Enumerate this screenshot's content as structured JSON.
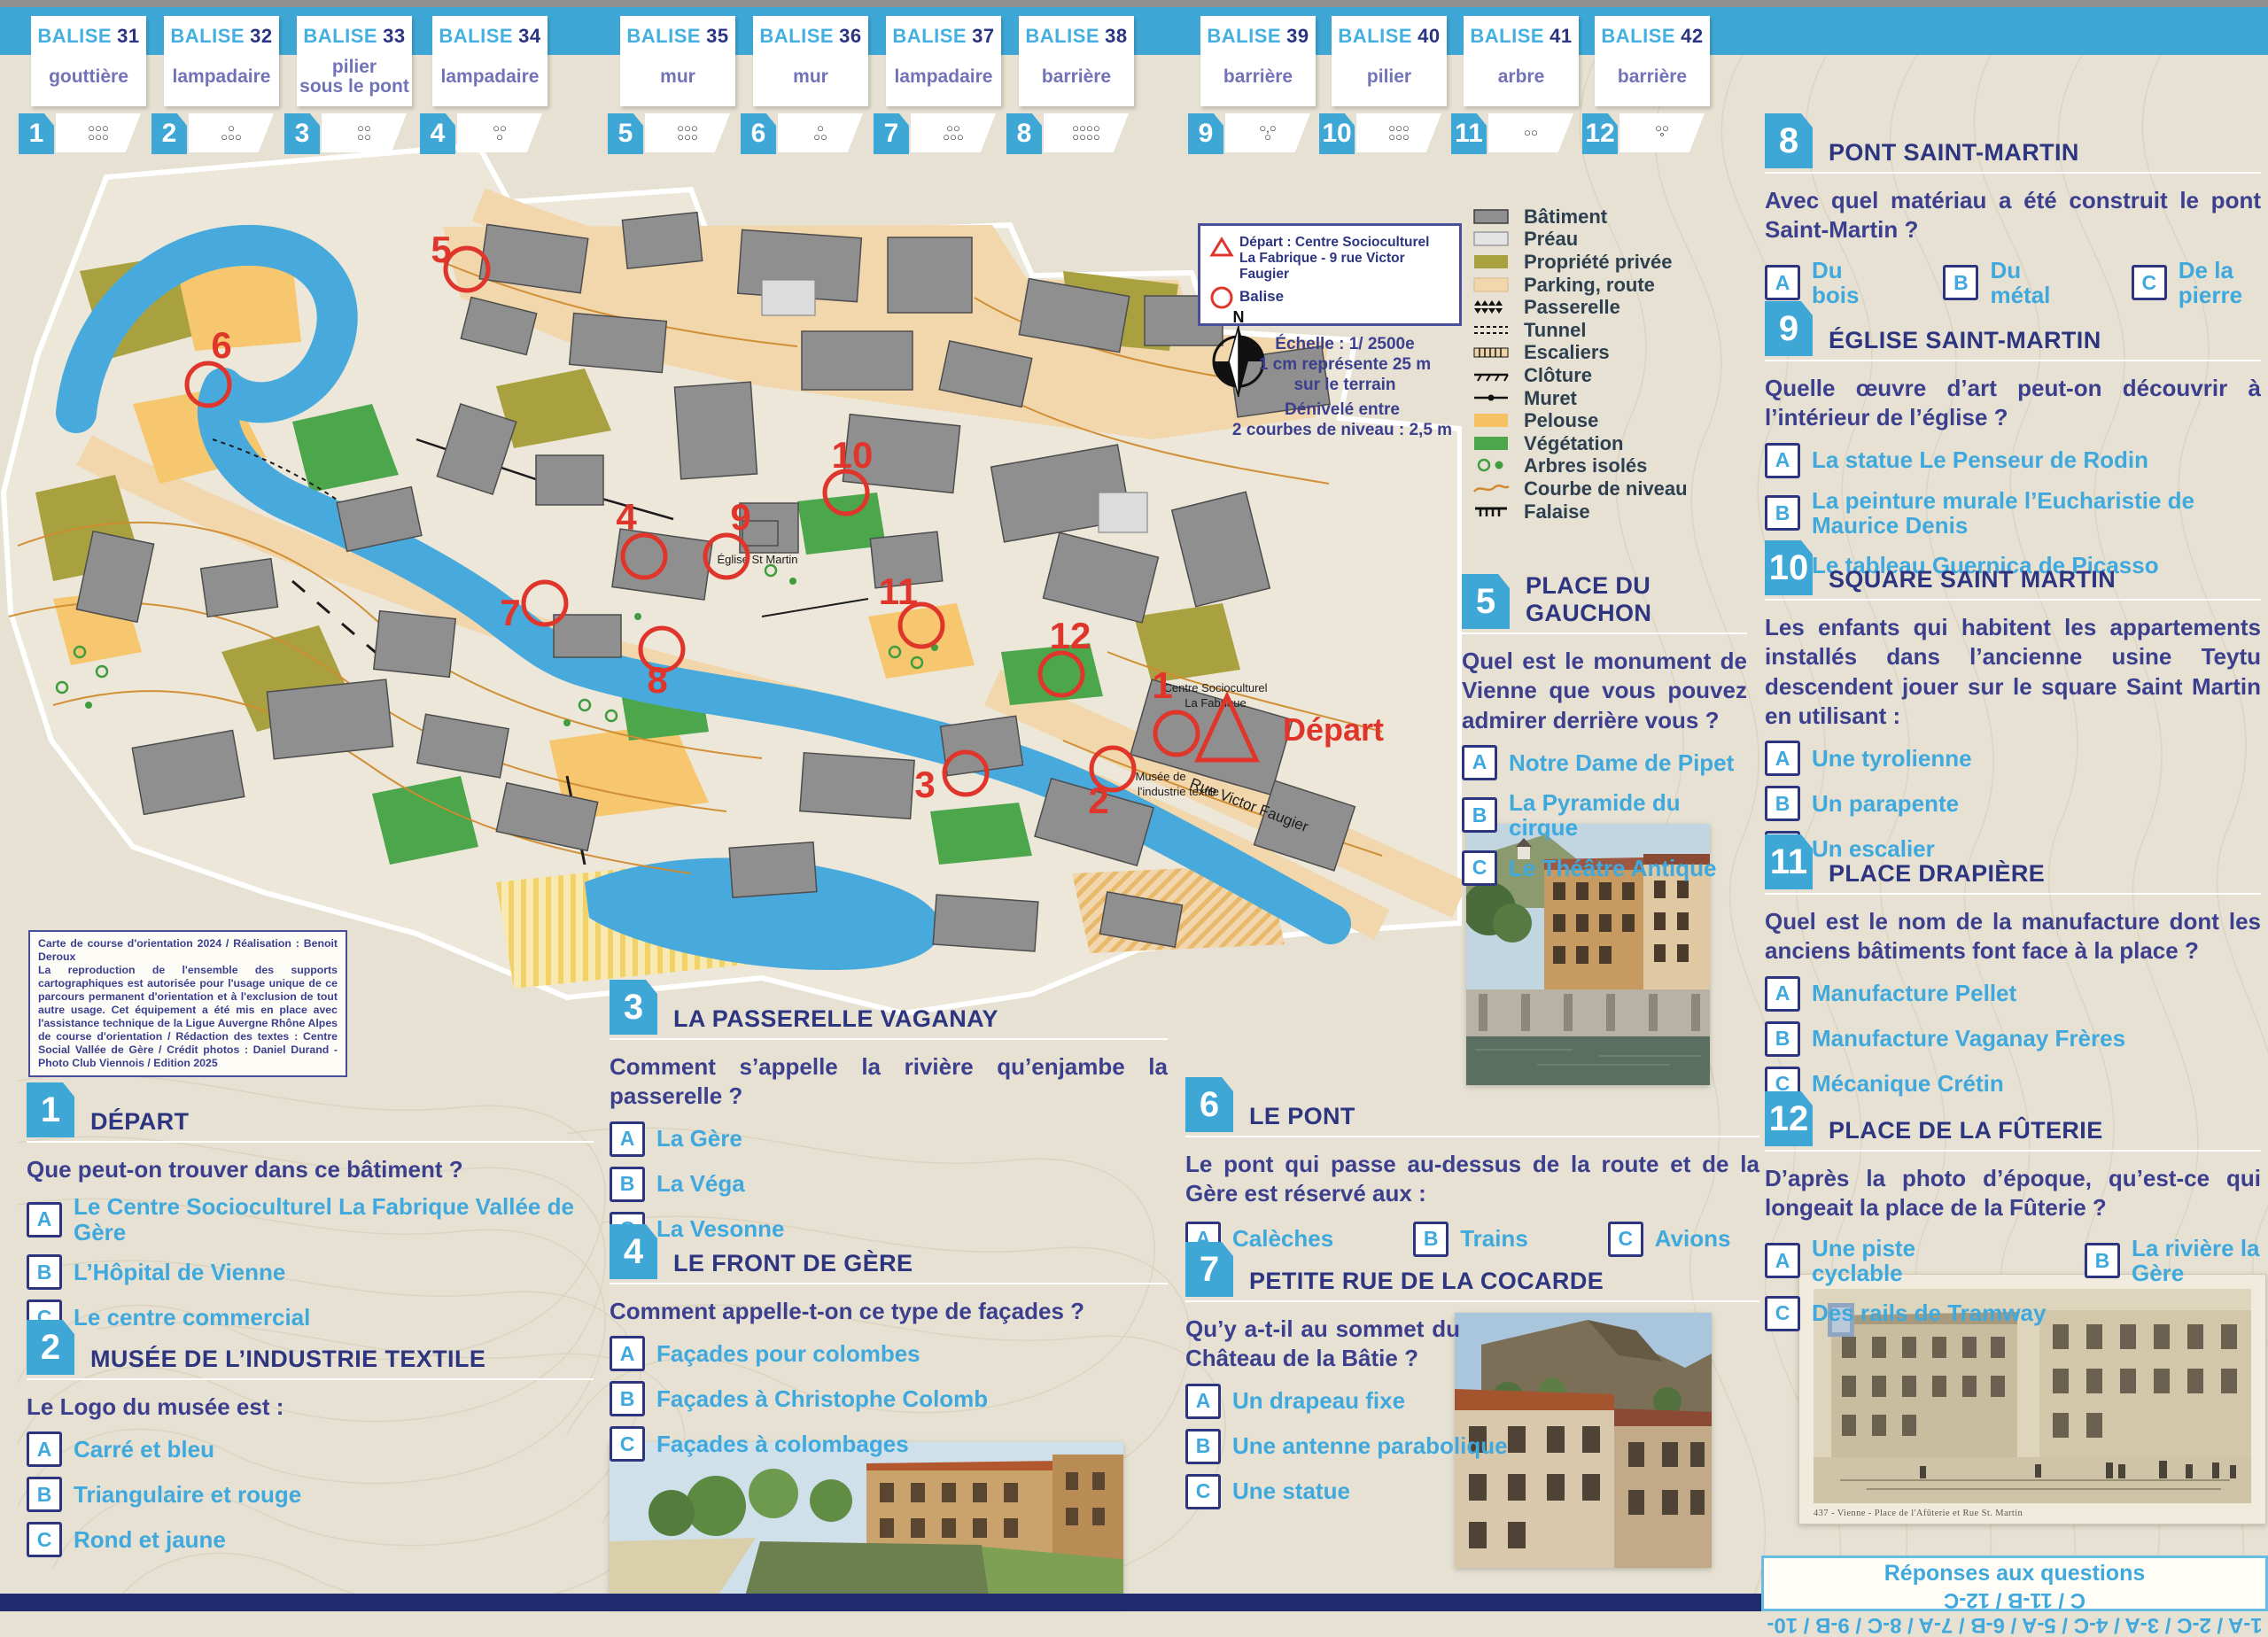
{
  "theme": {
    "band_blue": "#3fa7d6",
    "navy": "#2d3580",
    "answer_blue": "#3fa9dd",
    "card_purple": "#7272b8",
    "overprint_red": "#e0352b",
    "paper": "#e6e1d2"
  },
  "balise_word": "BALISE",
  "balises": [
    {
      "num": "31",
      "desc": "gouttière",
      "badge": "1",
      "symbol": "○○○\n○○○"
    },
    {
      "num": "32",
      "desc": "lampadaire",
      "badge": "2",
      "symbol": "○\n○○○"
    },
    {
      "num": "33",
      "desc": "pilier\nsous le pont",
      "badge": "3",
      "symbol": "○○\n○○"
    },
    {
      "num": "34",
      "desc": "lampadaire",
      "badge": "4",
      "symbol": "○○\n○"
    },
    {
      "num": "35",
      "desc": "mur",
      "badge": "5",
      "symbol": "○○○\n○○○"
    },
    {
      "num": "36",
      "desc": "mur",
      "badge": "6",
      "symbol": "○\n○○"
    },
    {
      "num": "37",
      "desc": "lampadaire",
      "badge": "7",
      "symbol": "○○\n○○○"
    },
    {
      "num": "38",
      "desc": "barrière",
      "badge": "8",
      "symbol": "○○○○\n○○○○"
    },
    {
      "num": "39",
      "desc": "barrière",
      "badge": "9",
      "symbol": "○,○\n○"
    },
    {
      "num": "40",
      "desc": "pilier",
      "badge": "10",
      "symbol": "○○○\n○○○"
    },
    {
      "num": "41",
      "desc": "arbre",
      "badge": "11",
      "symbol": "○○"
    },
    {
      "num": "42",
      "desc": "barrière",
      "badge": "12",
      "symbol": "○○\n°"
    }
  ],
  "map": {
    "compass_n": "N",
    "labels": {
      "depart": "Départ",
      "centre_1": "Centre Socioculturel",
      "centre_2": "La Fabrique",
      "musee_1": "Musée de",
      "musee_2": "l'industrie textile",
      "eglise": "Église St Martin",
      "rue": "Rue Victor Faugier"
    },
    "controls": [
      "1",
      "2",
      "3",
      "4",
      "5",
      "6",
      "7",
      "8",
      "9",
      "10",
      "11",
      "12"
    ],
    "start_legend": {
      "depart": "Départ : Centre Socioculturel\nLa Fabrique - 9 rue Victor Faugier",
      "balise": "Balise"
    },
    "scale": "Échelle : 1/ 2500e\n1 cm représente 25 m\nsur le terrain",
    "denivele": "Dénivelé entre\n2 courbes de niveau : 2,5 m",
    "credits": "Carte de course d'orientation 2024 / Réalisation : Benoit Deroux\nLa reproduction de l'ensemble des supports cartographiques est autorisée pour l'usage unique de ce parcours permanent d'orientation et à l'exclusion de tout autre usage. Cet équipement a été mis en place avec l'assistance technique de la Ligue Auvergne Rhône Alpes de course d'orientation / Rédaction des textes : Centre Social Vallée de Gère / Crédit photos : Daniel Durand - Photo Club Viennois / Edition 2025"
  },
  "legend": {
    "items": [
      {
        "label": "Bâtiment",
        "type": "building"
      },
      {
        "label": "Préau",
        "type": "preau"
      },
      {
        "label": "Propriété privée",
        "type": "private"
      },
      {
        "label": "Parking, route",
        "type": "parking"
      },
      {
        "label": "Passerelle",
        "type": "passerelle"
      },
      {
        "label": "Tunnel",
        "type": "tunnel"
      },
      {
        "label": "Escaliers",
        "type": "stairs"
      },
      {
        "label": "Clôture",
        "type": "fence"
      },
      {
        "label": "Muret",
        "type": "wall"
      },
      {
        "label": "Pelouse",
        "type": "lawn"
      },
      {
        "label": "Végétation",
        "type": "veg"
      },
      {
        "label": "Arbres isolés",
        "type": "trees"
      },
      {
        "label": "Courbe de niveau",
        "type": "contour"
      },
      {
        "label": "Falaise",
        "type": "cliff"
      }
    ]
  },
  "questions": [
    {
      "num": "1",
      "title": "DÉPART",
      "question": "Que peut-on trouver dans ce bâtiment ?",
      "layout": "stack",
      "answers": [
        {
          "letter": "A",
          "label": "Le Centre Socioculturel La Fabrique Vallée de Gère"
        },
        {
          "letter": "B",
          "label": "L’Hôpital de Vienne"
        },
        {
          "letter": "C",
          "label": "Le centre commercial"
        }
      ]
    },
    {
      "num": "2",
      "title": "MUSÉE DE L’INDUSTRIE TEXTILE",
      "question": "Le Logo du musée est :",
      "layout": "stack",
      "answers": [
        {
          "letter": "A",
          "label": "Carré et bleu"
        },
        {
          "letter": "B",
          "label": "Triangulaire et rouge"
        },
        {
          "letter": "C",
          "label": "Rond et jaune"
        }
      ]
    },
    {
      "num": "3",
      "title": "LA PASSERELLE VAGANAY",
      "question": "Comment s’appelle la rivière qu’enjambe la passerelle ?",
      "layout": "stack",
      "answers": [
        {
          "letter": "A",
          "label": "La Gère"
        },
        {
          "letter": "B",
          "label": "La Véga"
        },
        {
          "letter": "C",
          "label": "La Vesonne"
        }
      ]
    },
    {
      "num": "4",
      "title": "LE FRONT DE GÈRE",
      "question": "Comment appelle-t-on ce type de façades ?",
      "layout": "stack",
      "answers": [
        {
          "letter": "A",
          "label": "Façades pour colombes"
        },
        {
          "letter": "B",
          "label": "Façades à Christophe Colomb"
        },
        {
          "letter": "C",
          "label": "Façades à colombages"
        }
      ]
    },
    {
      "num": "5",
      "title": "PLACE DU GAUCHON",
      "question": "Quel est le monument de Vienne que vous pouvez admirer derrière vous ?",
      "layout": "stack",
      "answers": [
        {
          "letter": "A",
          "label": "Notre Dame de Pipet"
        },
        {
          "letter": "B",
          "label": "La Pyramide du cirque"
        },
        {
          "letter": "C",
          "label": "Le Théâtre Antique"
        }
      ]
    },
    {
      "num": "6",
      "title": "LE PONT",
      "question": "Le pont qui passe au-dessus de la route et de la Gère est réservé aux :",
      "layout": "row",
      "answers": [
        {
          "letter": "A",
          "label": "Calèches"
        },
        {
          "letter": "B",
          "label": "Trains"
        },
        {
          "letter": "C",
          "label": "Avions"
        }
      ]
    },
    {
      "num": "7",
      "title": "PETITE RUE DE LA COCARDE",
      "question": "Qu’y a-t-il au sommet du Château de la Bâtie ?",
      "layout": "stack",
      "answers": [
        {
          "letter": "A",
          "label": "Un drapeau fixe"
        },
        {
          "letter": "B",
          "label": "Une antenne parabolique"
        },
        {
          "letter": "C",
          "label": "Une statue"
        }
      ]
    },
    {
      "num": "8",
      "title": "PONT SAINT-MARTIN",
      "question": "Avec quel matériau a été construit le pont Saint-Martin ?",
      "layout": "row",
      "answers": [
        {
          "letter": "A",
          "label": "Du bois"
        },
        {
          "letter": "B",
          "label": "Du métal"
        },
        {
          "letter": "C",
          "label": "De la pierre"
        }
      ]
    },
    {
      "num": "9",
      "title": "ÉGLISE SAINT-MARTIN",
      "question": "Quelle œuvre d’art peut-on découvrir à l’intérieur de l’église ?",
      "layout": "stack",
      "answers": [
        {
          "letter": "A",
          "label": "La statue Le Penseur de Rodin"
        },
        {
          "letter": "B",
          "label": "La peinture murale l’Eucharistie de Maurice Denis"
        },
        {
          "letter": "C",
          "label": "Le tableau Guernica de Picasso"
        }
      ]
    },
    {
      "num": "10",
      "title": "SQUARE SAINT MARTIN",
      "question": "Les enfants qui habitent les appartements installés dans l’ancienne usine Teytu descendent jouer sur le square Saint Martin en utilisant :",
      "layout": "stack",
      "answers": [
        {
          "letter": "A",
          "label": "Une tyrolienne"
        },
        {
          "letter": "B",
          "label": "Un parapente"
        },
        {
          "letter": "C",
          "label": "Un escalier"
        }
      ]
    },
    {
      "num": "11",
      "title": "PLACE DRAPIÈRE",
      "question": "Quel est le nom de la manufacture dont les anciens bâtiments font face à la place ?",
      "layout": "stack",
      "answers": [
        {
          "letter": "A",
          "label": "Manufacture Pellet"
        },
        {
          "letter": "B",
          "label": "Manufacture Vaganay Frères"
        },
        {
          "letter": "C",
          "label": "Mécanique Crétin"
        }
      ]
    },
    {
      "num": "12",
      "title": "PLACE DE LA FÛTERIE",
      "question": "D’après la photo d’époque, qu’est-ce qui longeait la place de la Fûterie ?",
      "layout": "ab-row",
      "answers": [
        {
          "letter": "A",
          "label": "Une piste cyclable"
        },
        {
          "letter": "B",
          "label": "La rivière la Gère"
        },
        {
          "letter": "C",
          "label": "Des rails de Tramway"
        }
      ]
    }
  ],
  "postcard": {
    "caption": "437 - Vienne - Place de l'Afûterie et Rue St. Martin"
  },
  "answers_box": {
    "title": "Réponses aux questions",
    "line": "1-A / 2-C / 3-A / 4-C / 5-A / 6-B / 7-A / 8-C / 9-B / 10-C / 11-B / 12-C"
  }
}
